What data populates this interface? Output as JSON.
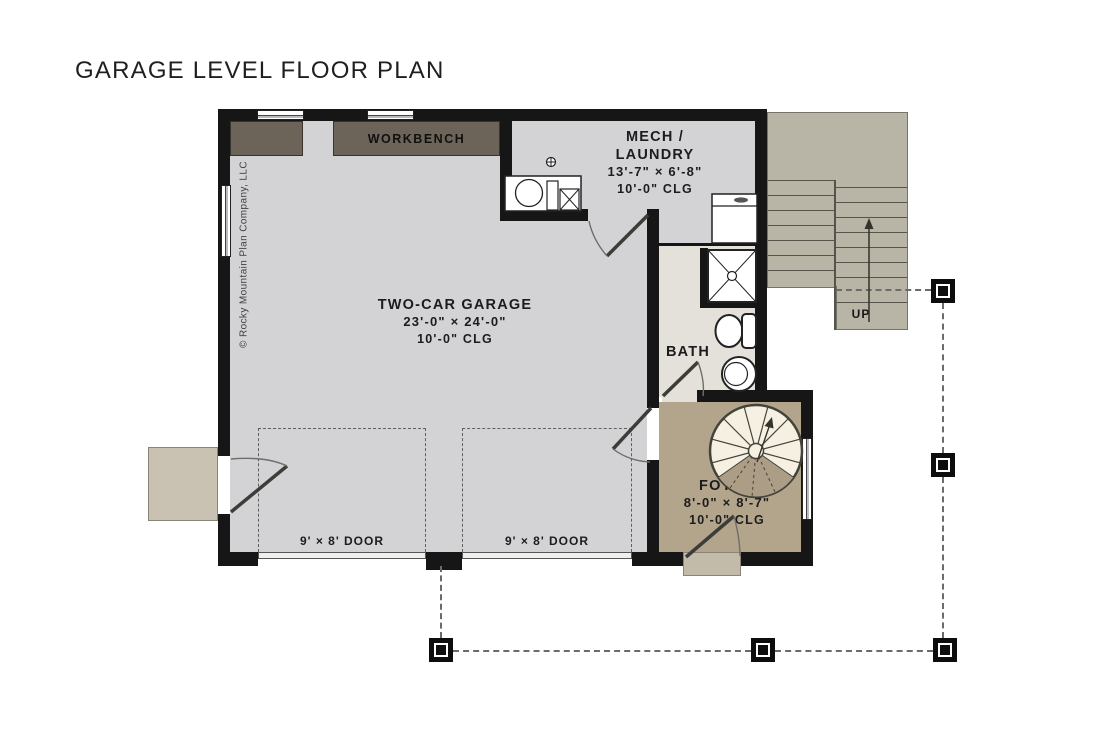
{
  "title": "GARAGE LEVEL FLOOR PLAN",
  "copyright": "© Rocky Mountain Plan Company, LLC",
  "rooms": {
    "garage": {
      "name": "TWO-CAR GARAGE",
      "dims": "23'-0\" × 24'-0\"",
      "ceiling": "10'-0\" CLG"
    },
    "mech": {
      "name_line1": "MECH /",
      "name_line2": "LAUNDRY",
      "dims": "13'-7\" × 6'-8\"",
      "ceiling": "10'-0\" CLG"
    },
    "bath": {
      "name": "BATH"
    },
    "foyer": {
      "name": "FOYER",
      "dims": "8'-0\" × 8'-7\"",
      "ceiling": "10'-0\" CLG"
    }
  },
  "labels": {
    "workbench": "WORKBENCH",
    "washer_dryer": "W/D",
    "stairs_up": "UP",
    "spiral_up": "UP",
    "garage_door_left": "9' × 8' DOOR",
    "garage_door_right": "9' × 8' DOOR"
  },
  "colors": {
    "wall": "#161616",
    "garage_floor": "#d3d3d5",
    "bath_floor": "#e4e1da",
    "foyer_floor": "#b3a48c",
    "workbench": "#6d6459",
    "stairs": "#b9b5a6",
    "stoop": "#c9c1b2",
    "spiral_tread": "#f5f0e2"
  }
}
